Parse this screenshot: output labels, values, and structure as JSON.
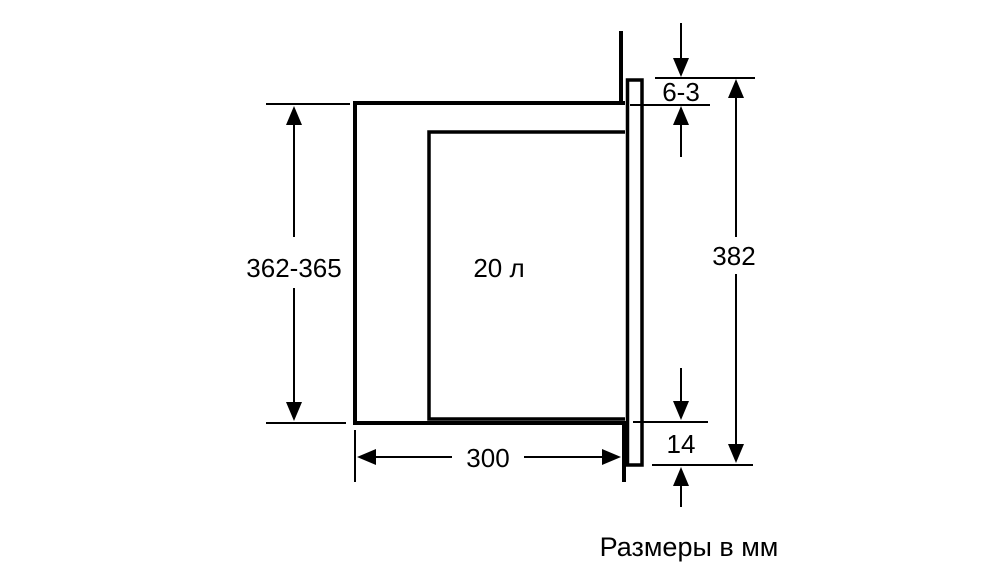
{
  "diagram": {
    "caption": "Размеры в мм",
    "labels": {
      "niche_height": "362-365",
      "capacity": "20 л",
      "top_gap": "6-3",
      "panel_height": "382",
      "bottom_overlap": "14",
      "depth": "300"
    },
    "colors": {
      "line": "#000000",
      "background": "#ffffff"
    }
  }
}
